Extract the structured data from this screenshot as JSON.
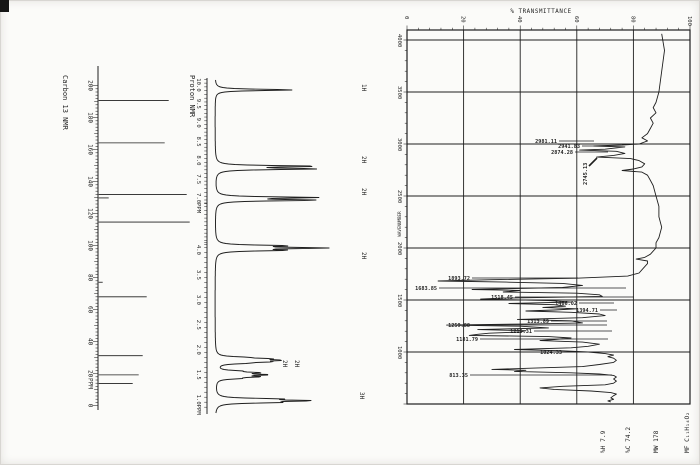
{
  "page": {
    "ink": "#1f1f1f",
    "paper": "#fbfbf9"
  },
  "chart_data": [
    {
      "type": "line",
      "id": "carbon13-nmr",
      "title": "Carbon 13 NMR",
      "x_unit": "PPM",
      "xlim": [
        205,
        -2
      ],
      "x_tick_labels": [
        "200",
        "180",
        "160",
        "140",
        "120",
        "100",
        "80",
        "60",
        "40",
        "20",
        "0"
      ],
      "peaks": [
        {
          "ppm": 190.7,
          "h": 70
        },
        {
          "ppm": 164.2,
          "h": 66
        },
        {
          "ppm": 132.0,
          "h": 88
        },
        {
          "ppm": 129.8,
          "h": 10
        },
        {
          "ppm": 114.7,
          "h": 91
        },
        {
          "ppm": 77.1,
          "h": 4
        },
        {
          "ppm": 68.0,
          "h": 48
        },
        {
          "ppm": 31.2,
          "h": 44
        },
        {
          "ppm": 19.2,
          "h": 40
        },
        {
          "ppm": 13.8,
          "h": 34
        }
      ]
    },
    {
      "type": "line",
      "id": "proton-nmr",
      "title": "Proton NMR",
      "x_unit": "PPM",
      "segments": [
        {
          "range": [
            10.0,
            7.0
          ],
          "tick_labels": [
            "10.0",
            "9.5",
            "9.0",
            "8.5",
            "8.0",
            "7.5",
            "7.0"
          ],
          "unit": "PPM"
        },
        {
          "range": [
            4.0,
            1.0
          ],
          "tick_labels": [
            "4.0",
            "3.5",
            "3.0",
            "2.5",
            "2.0",
            "1.5",
            "1.0"
          ],
          "unit": "PPM"
        }
      ],
      "peaks": [
        {
          "ppm": 9.87,
          "integration": "1H",
          "lines": [
            [
              0,
              78
            ]
          ]
        },
        {
          "ppm": 7.81,
          "integration": "2H",
          "lines": [
            [
              -0.035,
              96
            ],
            [
              0.035,
              96
            ]
          ]
        },
        {
          "ppm": 6.98,
          "integration": "2H",
          "lines": [
            [
              -0.035,
              96
            ],
            [
              0.035,
              96
            ]
          ]
        },
        {
          "ppm": 4.04,
          "integration": "2H",
          "lines": [
            [
              -0.045,
              62
            ],
            [
              0,
              100
            ],
            [
              0.045,
              62
            ]
          ]
        },
        {
          "ppm": 1.79,
          "integration": "2H",
          "lines": [
            [
              -0.06,
              20
            ],
            [
              -0.03,
              40
            ],
            [
              0,
              48
            ],
            [
              0.03,
              40
            ],
            [
              0.06,
              20
            ]
          ]
        },
        {
          "ppm": 1.5,
          "integration": "2H",
          "lines": [
            [
              -0.075,
              18
            ],
            [
              -0.04,
              36
            ],
            [
              0,
              44
            ],
            [
              0.04,
              36
            ],
            [
              0.075,
              18
            ]
          ]
        },
        {
          "ppm": 0.98,
          "integration": "3H",
          "lines": [
            [
              -0.035,
              52
            ],
            [
              0,
              82
            ],
            [
              0.035,
              52
            ]
          ]
        }
      ],
      "integration_labels": [
        {
          "t": "1H",
          "x": 362,
          "y": 84
        },
        {
          "t": "2H",
          "x": 362,
          "y": 156
        },
        {
          "t": "2H",
          "x": 362,
          "y": 188
        },
        {
          "t": "2H",
          "x": 362,
          "y": 252
        },
        {
          "t": "2H",
          "x": 283,
          "y": 360
        },
        {
          "t": "2H",
          "x": 295,
          "y": 360
        },
        {
          "t": "3H",
          "x": 360,
          "y": 392
        }
      ]
    },
    {
      "type": "line",
      "id": "ir-spectrum",
      "title": "% TRANSMITTANCE",
      "y_axis_label": "WAVENUMBER",
      "t_range": [
        0,
        100
      ],
      "wn_range": [
        4000,
        500
      ],
      "t_tick_labels": [
        "0",
        "20",
        "40",
        "60",
        "80",
        "100"
      ],
      "wn_tick_labels": [
        "4000",
        "3500",
        "3000",
        "2500",
        "2000",
        "1500",
        "1000"
      ],
      "curve": [
        [
          4060,
          90
        ],
        [
          3900,
          91
        ],
        [
          3700,
          90
        ],
        [
          3500,
          89
        ],
        [
          3400,
          88
        ],
        [
          3350,
          87
        ],
        [
          3300,
          88
        ],
        [
          3250,
          86
        ],
        [
          3200,
          87
        ],
        [
          3150,
          86
        ],
        [
          3100,
          85
        ],
        [
          3060,
          83
        ],
        [
          3030,
          85
        ],
        [
          3000,
          82
        ],
        [
          2990,
          76
        ],
        [
          2981,
          66
        ],
        [
          2972,
          77
        ],
        [
          2960,
          73
        ],
        [
          2950,
          70
        ],
        [
          2941,
          61
        ],
        [
          2930,
          74
        ],
        [
          2910,
          77
        ],
        [
          2890,
          73
        ],
        [
          2874,
          67
        ],
        [
          2860,
          79
        ],
        [
          2840,
          82
        ],
        [
          2810,
          84
        ],
        [
          2780,
          83
        ],
        [
          2760,
          80
        ],
        [
          2745,
          76
        ],
        [
          2730,
          83
        ],
        [
          2700,
          85
        ],
        [
          2650,
          86
        ],
        [
          2600,
          87
        ],
        [
          2500,
          88
        ],
        [
          2400,
          89
        ],
        [
          2300,
          89
        ],
        [
          2200,
          90
        ],
        [
          2100,
          89
        ],
        [
          2050,
          88
        ],
        [
          2000,
          88
        ],
        [
          1970,
          87
        ],
        [
          1940,
          86
        ],
        [
          1910,
          84
        ],
        [
          1893,
          81
        ],
        [
          1875,
          85
        ],
        [
          1850,
          85
        ],
        [
          1820,
          84
        ],
        [
          1790,
          83
        ],
        [
          1760,
          82
        ],
        [
          1730,
          78
        ],
        [
          1710,
          60
        ],
        [
          1695,
          30
        ],
        [
          1683,
          11
        ],
        [
          1672,
          35
        ],
        [
          1660,
          55
        ],
        [
          1640,
          62
        ],
        [
          1620,
          55
        ],
        [
          1601,
          23
        ],
        [
          1592,
          40
        ],
        [
          1577,
          34
        ],
        [
          1565,
          60
        ],
        [
          1550,
          68
        ],
        [
          1535,
          69
        ],
        [
          1518,
          34
        ],
        [
          1509,
          26
        ],
        [
          1495,
          50
        ],
        [
          1480,
          58
        ],
        [
          1466,
          36
        ],
        [
          1455,
          52
        ],
        [
          1440,
          56
        ],
        [
          1429,
          48
        ],
        [
          1415,
          60
        ],
        [
          1404,
          52
        ],
        [
          1394,
          42
        ],
        [
          1382,
          58
        ],
        [
          1365,
          68
        ],
        [
          1350,
          70
        ],
        [
          1330,
          62
        ],
        [
          1313,
          39
        ],
        [
          1300,
          58
        ],
        [
          1280,
          62
        ],
        [
          1270,
          45
        ],
        [
          1259,
          14
        ],
        [
          1248,
          40
        ],
        [
          1232,
          50
        ],
        [
          1215,
          25
        ],
        [
          1205,
          42
        ],
        [
          1192,
          40
        ],
        [
          1181,
          29
        ],
        [
          1170,
          25
        ],
        [
          1160,
          22
        ],
        [
          1148,
          50
        ],
        [
          1135,
          58
        ],
        [
          1120,
          52
        ],
        [
          1110,
          47
        ],
        [
          1095,
          62
        ],
        [
          1075,
          68
        ],
        [
          1055,
          64
        ],
        [
          1040,
          58
        ],
        [
          1024,
          38
        ],
        [
          1012,
          55
        ],
        [
          1000,
          64
        ],
        [
          985,
          70
        ],
        [
          970,
          73
        ],
        [
          955,
          71
        ],
        [
          940,
          73
        ],
        [
          920,
          74
        ],
        [
          900,
          73
        ],
        [
          880,
          68
        ],
        [
          860,
          62
        ],
        [
          845,
          45
        ],
        [
          833,
          30
        ],
        [
          824,
          42
        ],
        [
          813,
          38
        ],
        [
          800,
          58
        ],
        [
          788,
          68
        ],
        [
          775,
          73
        ],
        [
          760,
          74
        ],
        [
          740,
          73
        ],
        [
          720,
          74
        ],
        [
          700,
          73
        ],
        [
          685,
          70
        ],
        [
          670,
          55
        ],
        [
          655,
          47
        ],
        [
          640,
          52
        ],
        [
          625,
          65
        ],
        [
          610,
          72
        ],
        [
          595,
          74
        ],
        [
          580,
          73
        ],
        [
          560,
          72
        ],
        [
          545,
          73
        ],
        [
          530,
          71
        ],
        [
          520,
          72
        ]
      ],
      "peak_labels": [
        {
          "t": "2981.11",
          "x": 557,
          "y": 141,
          "ex": 594
        },
        {
          "t": "2941.83",
          "x": 580,
          "y": 146,
          "ex": 604
        },
        {
          "t": "2874.28",
          "x": 573,
          "y": 152,
          "ex": 608
        },
        {
          "t": "1893.72",
          "x": 470,
          "y": 278,
          "ex": 578
        },
        {
          "t": "1683.85",
          "x": 437,
          "y": 288,
          "ex": 626
        },
        {
          "t": "1518.45",
          "x": 513,
          "y": 297,
          "ex": 634
        },
        {
          "t": "1466.02",
          "x": 577,
          "y": 303,
          "ex": 614
        },
        {
          "t": "1394.71",
          "x": 598,
          "y": 310,
          "ex": 617
        },
        {
          "t": "1313.89",
          "x": 549,
          "y": 321,
          "ex": 607
        },
        {
          "t": "1259.88",
          "x": 470,
          "y": 325,
          "ex": 607
        },
        {
          "t": "1215.31",
          "x": 532,
          "y": 331,
          "ex": 612
        },
        {
          "t": "1181.79",
          "x": 478,
          "y": 339,
          "ex": 608
        },
        {
          "t": "1024.33",
          "x": 562,
          "y": 352,
          "ex": 608
        },
        {
          "t": "813.35",
          "x": 468,
          "y": 375,
          "ex": 612
        }
      ],
      "rotated_peak_label": {
        "t": "2745.13",
        "x": 587,
        "y": 185
      },
      "info": [
        {
          "t": "MF C₁₁H₁₄O₂",
          "x": 689
        },
        {
          "t": "MW 178",
          "x": 658
        },
        {
          "t": "%C 74.2",
          "x": 630
        },
        {
          "t": "%H 7.9",
          "x": 605
        }
      ]
    }
  ]
}
